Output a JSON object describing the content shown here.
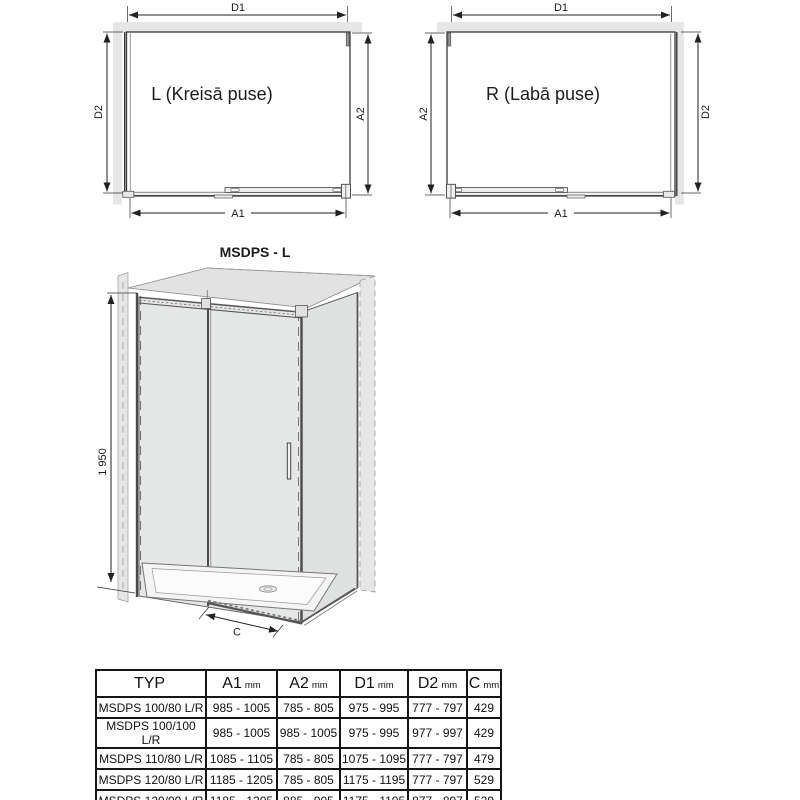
{
  "diagram_left": {
    "label": "L (Kreisā puse)",
    "dim_top": "D1",
    "dim_left": "D2",
    "dim_right": "A2",
    "dim_bottom": "A1"
  },
  "diagram_right": {
    "label": "R (Labā puse)",
    "dim_top": "D1",
    "dim_left": "A2",
    "dim_right": "D2",
    "dim_bottom": "A1"
  },
  "iso": {
    "title": "MSDPS - L",
    "height": "1 950",
    "width": "C"
  },
  "table": {
    "headers": [
      {
        "label": "TYP",
        "unit": ""
      },
      {
        "label": "A1",
        "unit": "mm"
      },
      {
        "label": "A2",
        "unit": "mm"
      },
      {
        "label": "D1",
        "unit": "mm"
      },
      {
        "label": "D2",
        "unit": "mm"
      },
      {
        "label": "C",
        "unit": "mm"
      }
    ],
    "rows": [
      {
        "typ": "MSDPS 100/80 L/R",
        "a1": "985 - 1005",
        "a2": "785 - 805",
        "d1": "975 - 995",
        "d2": "777 - 797",
        "c": "429"
      },
      {
        "typ": "MSDPS 100/100 L/R",
        "a1": "985 - 1005",
        "a2": "985 - 1005",
        "d1": "975 - 995",
        "d2": "977 - 997",
        "c": "429"
      },
      {
        "typ": "MSDPS 110/80 L/R",
        "a1": "1085 - 1105",
        "a2": "785 - 805",
        "d1": "1075 - 1095",
        "d2": "777 - 797",
        "c": "479"
      },
      {
        "typ": "MSDPS 120/80 L/R",
        "a1": "1185 - 1205",
        "a2": "785 - 805",
        "d1": "1175 - 1195",
        "d2": "777 - 797",
        "c": "529"
      },
      {
        "typ": "MSDPS 120/90 L/R",
        "a1": "1185 - 1205",
        "a2": "885 - 905",
        "d1": "1175 - 1195",
        "d2": "877 - 897",
        "c": "529"
      }
    ]
  },
  "colors": {
    "line": "#3a3a3a",
    "dimension": "#222222",
    "wall_fill": "#e6e6e6",
    "glass_front": "#e5e6e6",
    "glass_side": "#dfe0e0",
    "roof": "#e2e2e2",
    "table_border": "#161616"
  }
}
